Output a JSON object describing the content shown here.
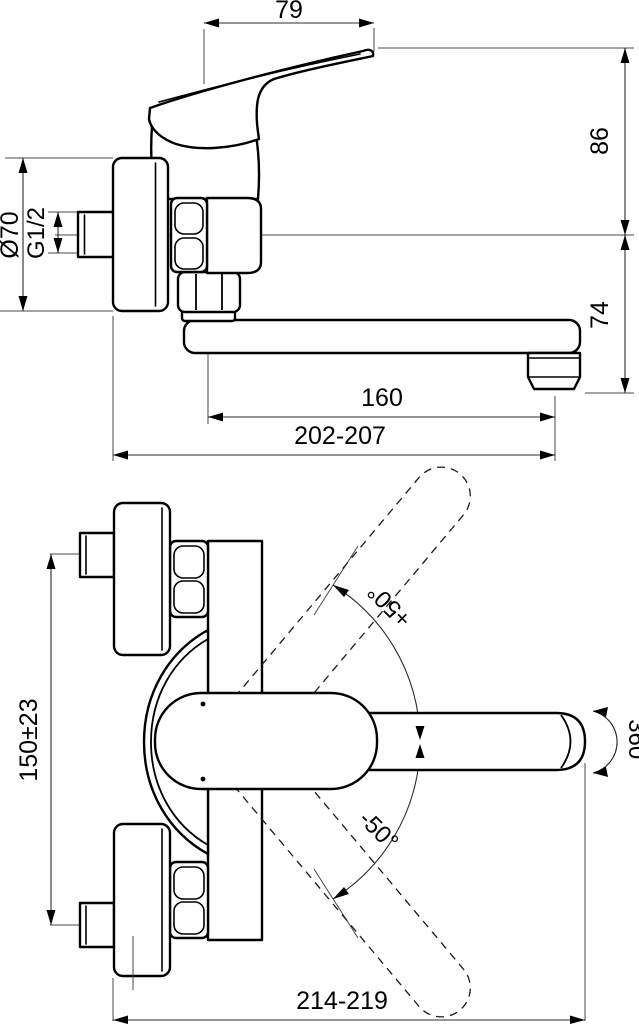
{
  "drawing": {
    "type": "technical-dimension-drawing",
    "subject": "wall-mounted single-lever mixer tap, side elevation and plan view",
    "line_color": "#000000",
    "background": "#ffffff",
    "dims_top": {
      "lever_width": "79",
      "height_axis_to_lever": "86",
      "axis_to_outlet": "74",
      "escutcheon_diameter": "Ø70",
      "connection_thread": "G1/2",
      "spout_reach": "160",
      "wall_to_outlet": "202-207"
    },
    "dims_plan": {
      "connection_spacing": "150±23",
      "swivel_up": "+50°",
      "swivel_down": "-50°",
      "spout_rotation": "360°",
      "overall_reach": "214-219"
    }
  }
}
